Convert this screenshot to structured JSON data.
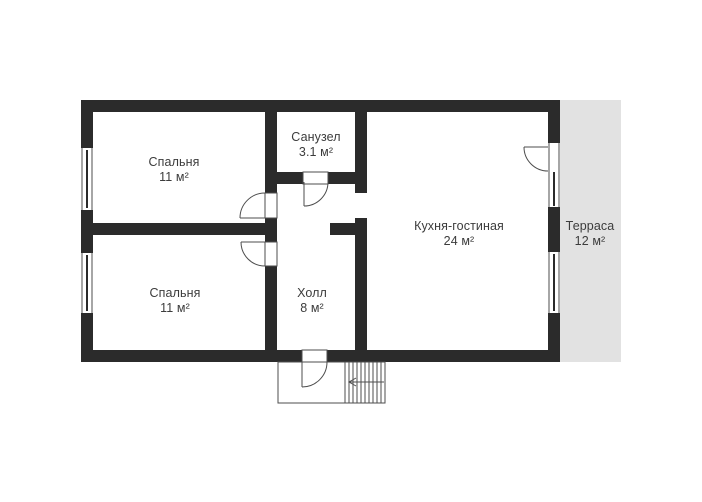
{
  "title": "Floor plan",
  "colors": {
    "wall": "#2b2b2b",
    "terrace_fill": "#e2e2e2",
    "line": "#4d4d4d",
    "text": "#3c3c3c",
    "background": "#ffffff"
  },
  "rooms": [
    {
      "id": "bedroom-1",
      "name": "Спальня",
      "area": "11 м²"
    },
    {
      "id": "bathroom",
      "name": "Санузел",
      "area": "3.1 м²"
    },
    {
      "id": "bedroom-2",
      "name": "Спальня",
      "area": "11 м²"
    },
    {
      "id": "hall",
      "name": "Холл",
      "area": "8 м²"
    },
    {
      "id": "kitchen-living",
      "name": "Кухня-гостиная",
      "area": "24 м²"
    },
    {
      "id": "terrace",
      "name": "Терраса",
      "area": "12 м²"
    }
  ]
}
